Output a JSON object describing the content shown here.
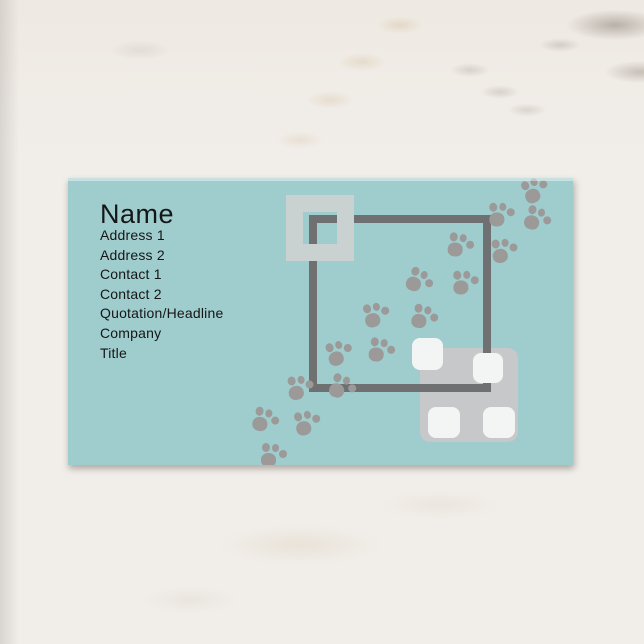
{
  "card": {
    "name": "Name",
    "fields": [
      "Address 1",
      "Address 2",
      "Contact 1",
      "Contact 2",
      "Quotation/Headline",
      "Company",
      "Title"
    ]
  },
  "colors": {
    "card-bg": "#9fcccd",
    "text": "#161616",
    "paw": "#9b9a99",
    "frame-dark": "#6f7072",
    "frame-light": "#c9d2d1",
    "rect-gray": "#c6c8ca",
    "square-white": "#f3f5f5",
    "marble-base": "#f1eeea"
  },
  "decorations": {
    "paw_prints": [
      {
        "left": 455,
        "top": -1,
        "rot": -25
      },
      {
        "left": 421,
        "top": 24,
        "rot": -5
      },
      {
        "left": 457,
        "top": 29,
        "rot": 15
      },
      {
        "left": 424,
        "top": 60,
        "rot": -10
      },
      {
        "left": 380,
        "top": 55,
        "rot": 5
      },
      {
        "left": 339,
        "top": 91,
        "rot": 20
      },
      {
        "left": 385,
        "top": 92,
        "rot": -5
      },
      {
        "left": 296,
        "top": 124,
        "rot": -15
      },
      {
        "left": 344,
        "top": 127,
        "rot": 10
      },
      {
        "left": 259,
        "top": 162,
        "rot": -20
      },
      {
        "left": 301,
        "top": 160,
        "rot": 5
      },
      {
        "left": 220,
        "top": 197,
        "rot": -10
      },
      {
        "left": 262,
        "top": 197,
        "rot": 15
      },
      {
        "left": 185,
        "top": 230,
        "rot": 10
      },
      {
        "left": 227,
        "top": 232,
        "rot": -15
      },
      {
        "left": 193,
        "top": 265,
        "rot": 0
      }
    ],
    "white_squares": [
      {
        "left": 344,
        "top": 160,
        "w": 31,
        "h": 32
      },
      {
        "left": 405,
        "top": 175,
        "w": 30,
        "h": 30
      },
      {
        "left": 360,
        "top": 229,
        "w": 32,
        "h": 31
      },
      {
        "left": 415,
        "top": 229,
        "w": 32,
        "h": 31
      }
    ]
  }
}
